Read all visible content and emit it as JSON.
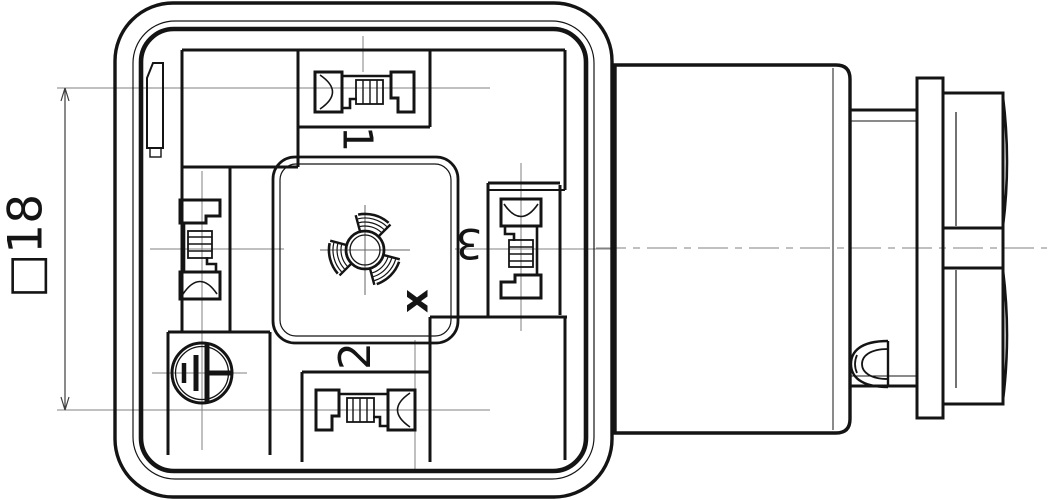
{
  "drawing": {
    "type": "technical-drawing-connector",
    "views": [
      "front-view",
      "side-view"
    ],
    "labels": {
      "dimension": "□18",
      "terminal_1": "1",
      "terminal_2": "2",
      "terminal_3": "3",
      "center_mark": "x"
    },
    "colors": {
      "background": "#ffffff",
      "line": "#141414",
      "centerline": "#828282",
      "dimension_line": "#3c3c3c"
    }
  }
}
